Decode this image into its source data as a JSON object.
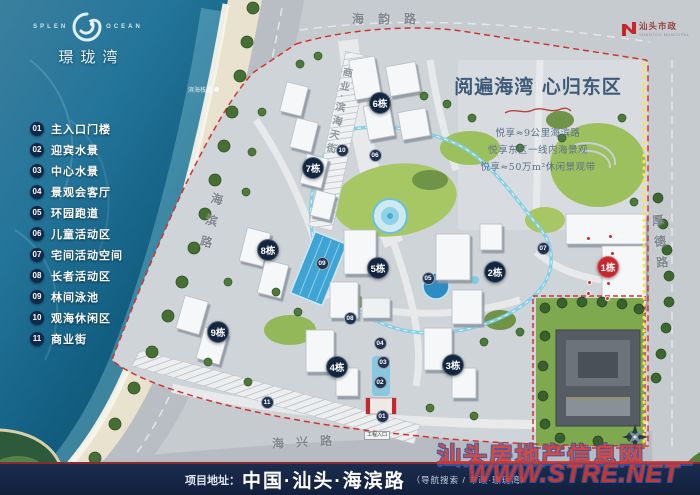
{
  "brand": {
    "name_cn": "璟珑湾",
    "en_left": "SPLEN",
    "en_right": "OCEAN"
  },
  "developer": {
    "name": "汕头市政",
    "sub": "SHANTOU MUNICIPAL"
  },
  "legend": [
    {
      "num": "01",
      "label": "主入口门楼"
    },
    {
      "num": "02",
      "label": "迎宾水景"
    },
    {
      "num": "03",
      "label": "中心水景"
    },
    {
      "num": "04",
      "label": "景观会客厅"
    },
    {
      "num": "05",
      "label": "环园跑道"
    },
    {
      "num": "06",
      "label": "儿童活动区"
    },
    {
      "num": "07",
      "label": "宅间活动空间"
    },
    {
      "num": "08",
      "label": "长者活动区"
    },
    {
      "num": "09",
      "label": "林间泳池"
    },
    {
      "num": "10",
      "label": "观海休闲区"
    },
    {
      "num": "11",
      "label": "商业街"
    }
  ],
  "roads": {
    "top": "海韵路",
    "left": "海滨路",
    "bottom": "海兴路",
    "right": "厚德路",
    "street": "商业·滨海天街"
  },
  "headline": {
    "title": "阅遍海湾 心归东区",
    "lines": [
      "悦享≈9公里海滨路",
      "悦享东区一线内海景观",
      "悦享≈50万m²休闲景观带"
    ]
  },
  "map": {
    "building_badges": [
      {
        "label": "1栋",
        "x": 608,
        "y": 267,
        "red": true
      },
      {
        "label": "2栋",
        "x": 495,
        "y": 272
      },
      {
        "label": "3栋",
        "x": 453,
        "y": 365
      },
      {
        "label": "4栋",
        "x": 337,
        "y": 367
      },
      {
        "label": "5栋",
        "x": 378,
        "y": 268
      },
      {
        "label": "6栋",
        "x": 380,
        "y": 103
      },
      {
        "label": "7栋",
        "x": 313,
        "y": 168
      },
      {
        "label": "8栋",
        "x": 268,
        "y": 250
      },
      {
        "label": "9栋",
        "x": 218,
        "y": 332
      }
    ],
    "spot_markers": [
      {
        "num": "01",
        "x": 382,
        "y": 416
      },
      {
        "num": "02",
        "x": 380,
        "y": 382
      },
      {
        "num": "03",
        "x": 383,
        "y": 362
      },
      {
        "num": "04",
        "x": 380,
        "y": 343
      },
      {
        "num": "05",
        "x": 428,
        "y": 278
      },
      {
        "num": "06",
        "x": 375,
        "y": 155
      },
      {
        "num": "07",
        "x": 543,
        "y": 248
      },
      {
        "num": "08",
        "x": 350,
        "y": 318
      },
      {
        "num": "09",
        "x": 322,
        "y": 263
      },
      {
        "num": "10",
        "x": 342,
        "y": 150
      },
      {
        "num": "11",
        "x": 267,
        "y": 402
      }
    ],
    "red_points": [
      [
        588,
        238
      ],
      [
        610,
        236
      ],
      [
        612,
        253
      ],
      [
        589,
        282
      ],
      [
        608,
        283
      ],
      [
        588,
        293
      ],
      [
        607,
        298
      ]
    ],
    "beach_label": "滨海栈道",
    "gate_label": "工程入口"
  },
  "footer": {
    "prefix": "项目地址：",
    "address": "中国·汕头·海滨路",
    "note": "（导航搜索 / 市政·璟珑湾）"
  },
  "watermark": {
    "line1": "汕头房地产信息网",
    "line2": "WWW.STRE.NET"
  },
  "colors": {
    "accent_red": "#c5272d",
    "badge_navy": "#13263f",
    "boundary_red": "#d23430"
  }
}
